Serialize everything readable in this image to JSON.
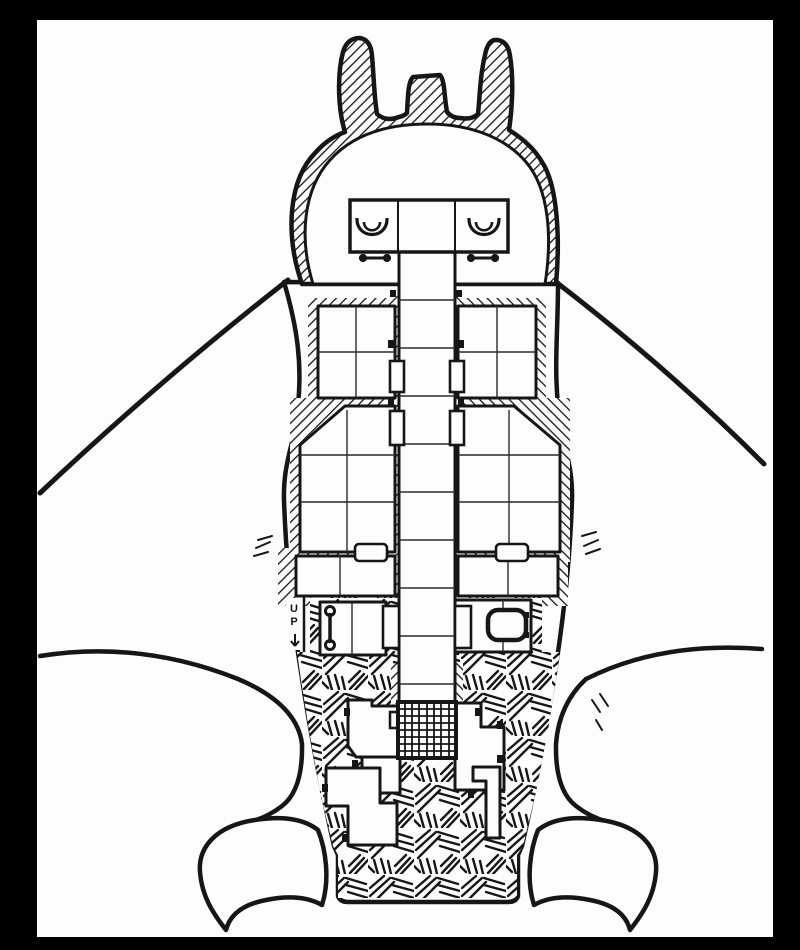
{
  "map": {
    "up_label": "UP",
    "colors": {
      "frame": "#000000",
      "paper": "#fdfdfd",
      "ink": "#161616"
    },
    "features": [
      "left-horn",
      "right-horn",
      "head-crest",
      "head-chamber",
      "left-crescent-brazier",
      "right-crescent-brazier",
      "central-corridor",
      "side-rooms",
      "portcullis-grate",
      "stairs-up",
      "basin",
      "left-wing",
      "right-wing",
      "left-foot-claw",
      "right-foot-claw",
      "tail-block"
    ]
  }
}
